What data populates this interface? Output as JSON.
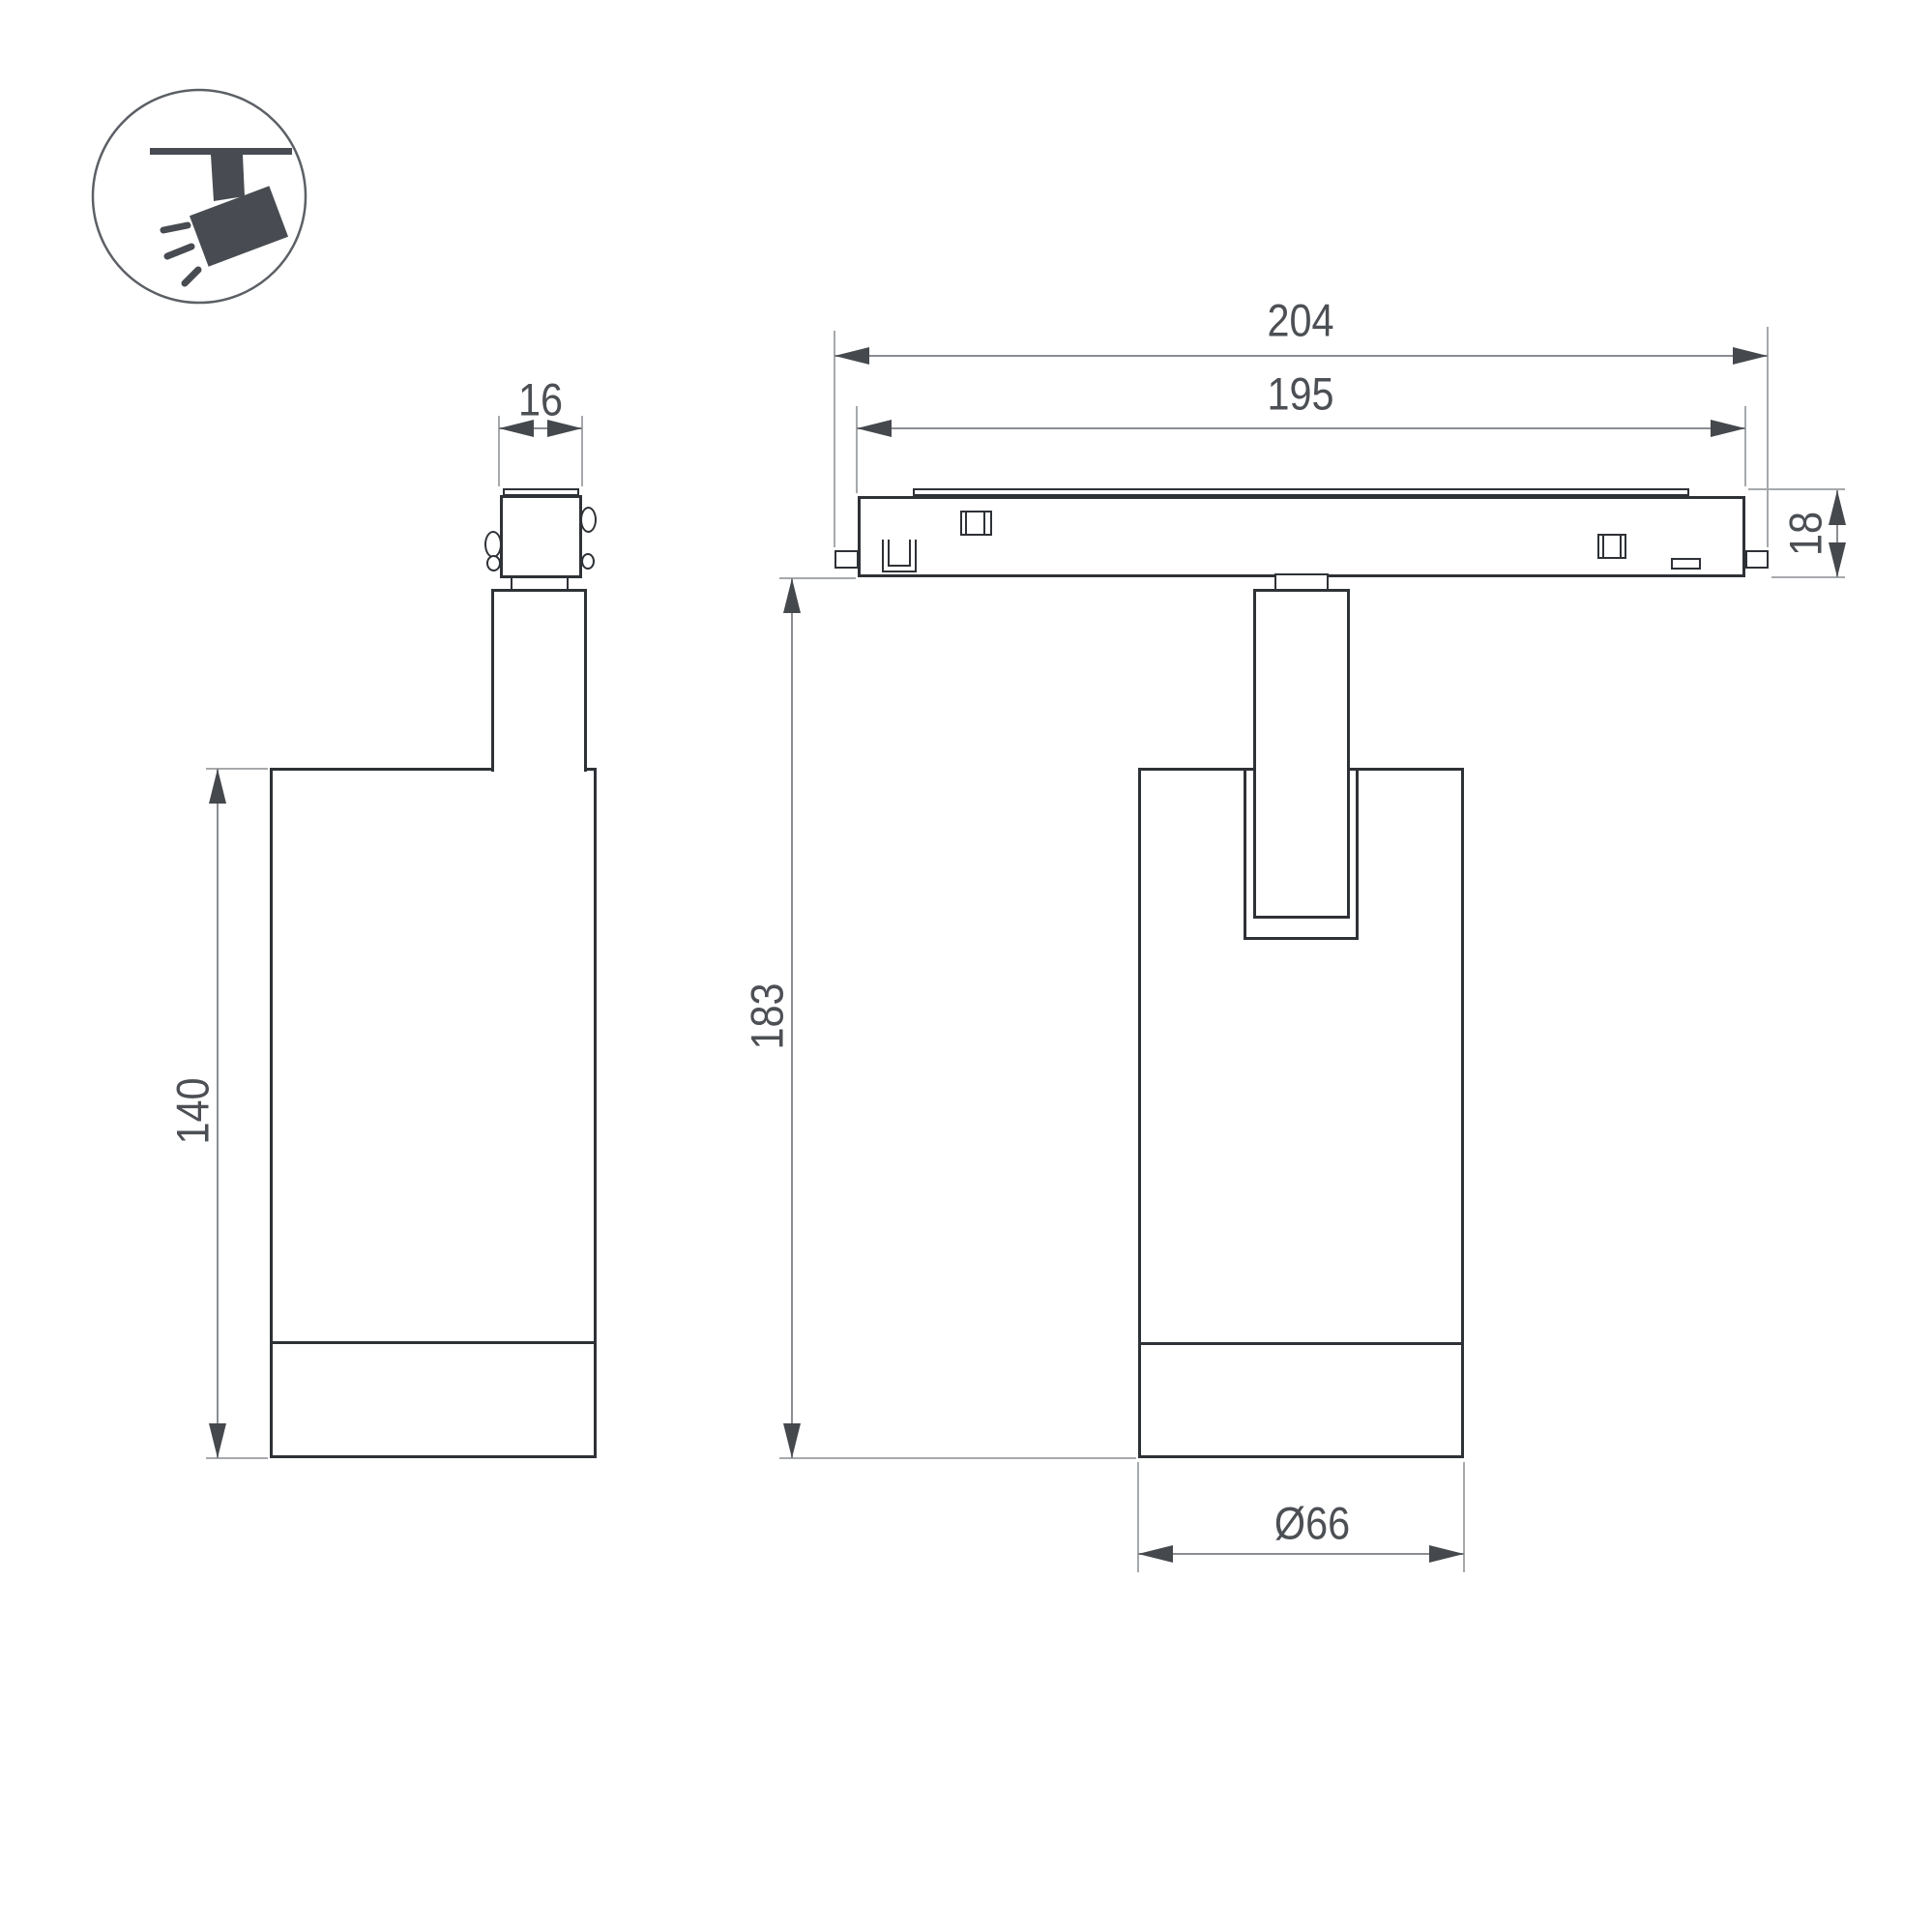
{
  "drawing": {
    "type": "technical-dimension-drawing",
    "product": "track-mounted spotlight luminaire",
    "colors": {
      "background": "#ffffff",
      "outline": "#2e3136",
      "dimension_line": "#8a8d91",
      "extension_line": "#a6a9ac",
      "arrow": "#45484d",
      "text": "#4c4f54",
      "icon": "#484c52"
    },
    "icon": {
      "name": "ceiling-spotlight-pictogram",
      "description": "tilted spotlight hanging from ceiling line with light rays"
    },
    "dims": {
      "connector_width": "16",
      "body_height": "140",
      "track_length_outer": "204",
      "track_length_inner": "195",
      "track_height": "18",
      "fixture_height": "183",
      "body_diameter": "Ø66"
    }
  }
}
